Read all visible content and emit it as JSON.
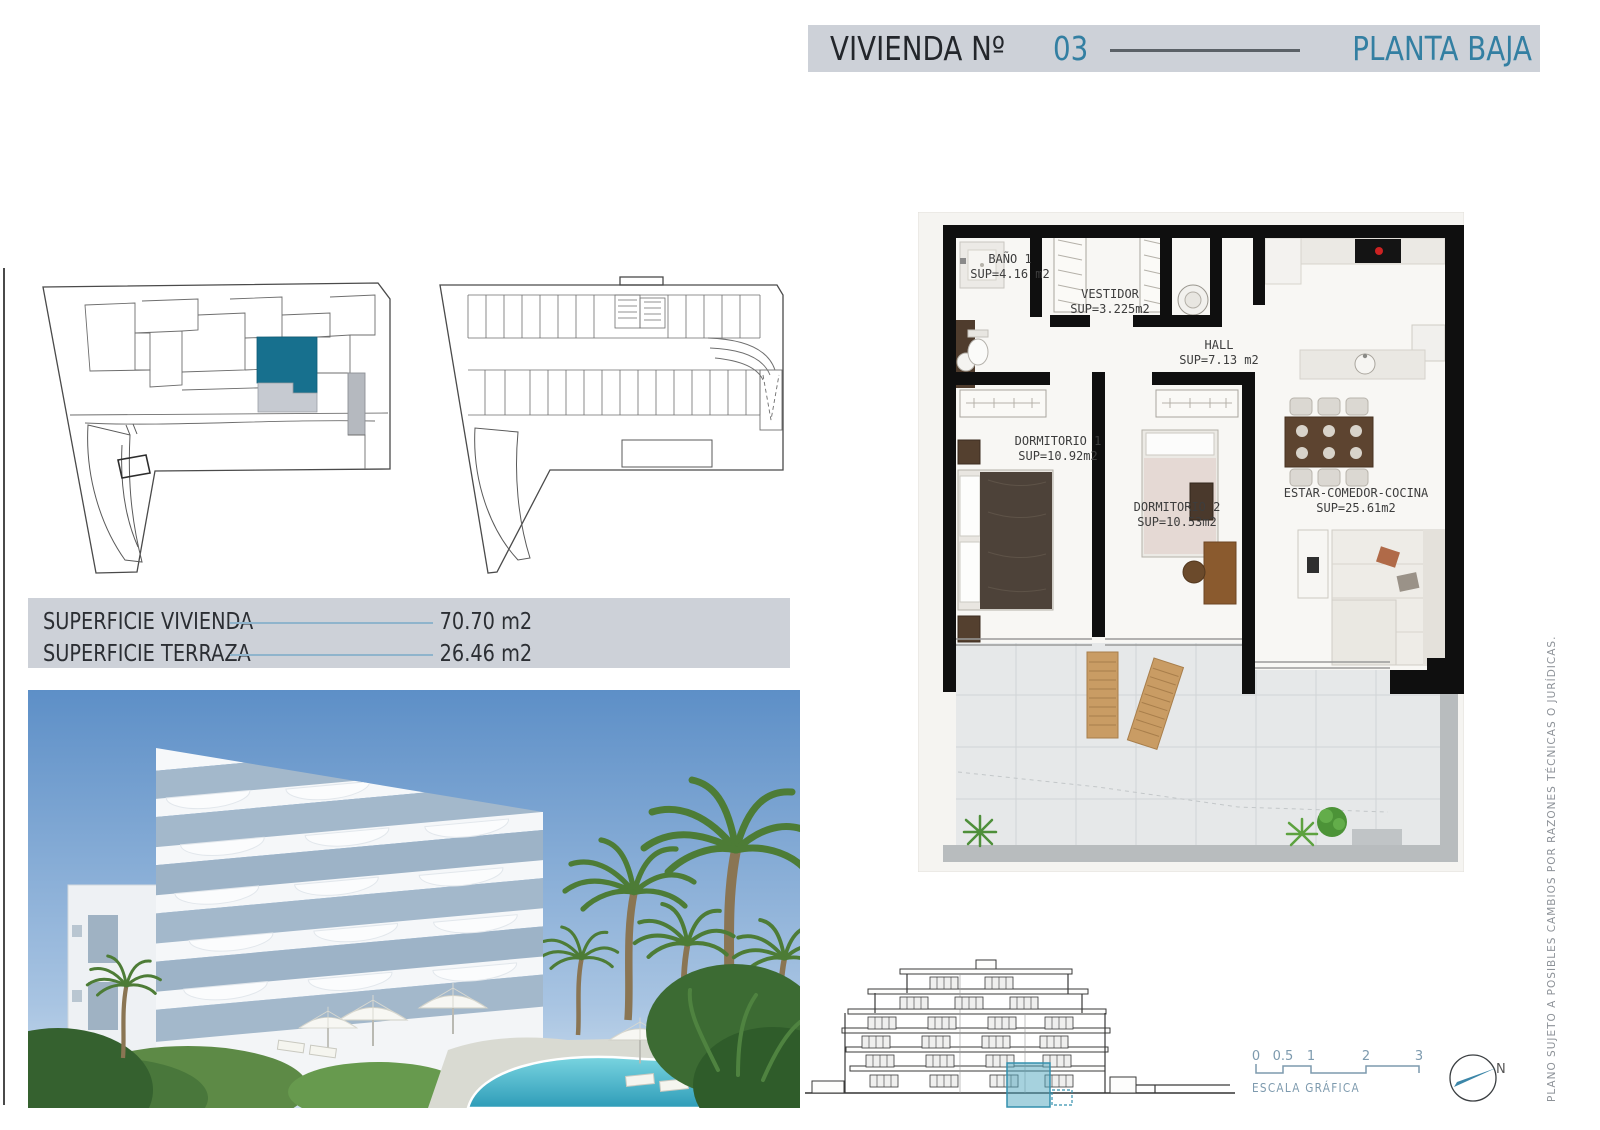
{
  "header": {
    "title_label": "VIVIENDA Nº",
    "unit_number": "03",
    "floor_label": "PLANTA BAJA"
  },
  "surfaces": {
    "rows": [
      {
        "label": "SUPERFICIE VIVIENDA",
        "value": "70.70 m2"
      },
      {
        "label": "SUPERFICIE TERRAZA",
        "value": "26.46 m2"
      }
    ]
  },
  "floor_plan": {
    "rooms": [
      {
        "name": "BAÑO 1",
        "area": "SUP=4.16 m2"
      },
      {
        "name": "VESTIDOR",
        "area": "SUP=3.225m2"
      },
      {
        "name": "HALL",
        "area": "SUP=7.13 m2"
      },
      {
        "name": "DORMITORIO 1",
        "area": "SUP=10.92m2"
      },
      {
        "name": "DORMITORIO 2",
        "area": "SUP=10.53m2"
      },
      {
        "name": "ESTAR-COMEDOR-COCINA",
        "area": "SUP=25.61m2"
      }
    ]
  },
  "scale_bar": {
    "ticks": [
      "0",
      "0.5",
      "1",
      "2",
      "3"
    ],
    "label": "ESCALA GRÁFICA"
  },
  "compass": {
    "north_label": "N"
  },
  "disclaimer": {
    "text": "PLANO SUJETO A POSIBLES CAMBIOS POR RAZONES TÉCNICAS O JURÍDICAS."
  },
  "colors": {
    "accent_teal": "#337fa2",
    "highlight_unit_teal": "#17708e",
    "header_bar_bg": "#cdd1d8",
    "scale_teal": "#7d9aae",
    "plan_wall": "#0f0f0f"
  }
}
